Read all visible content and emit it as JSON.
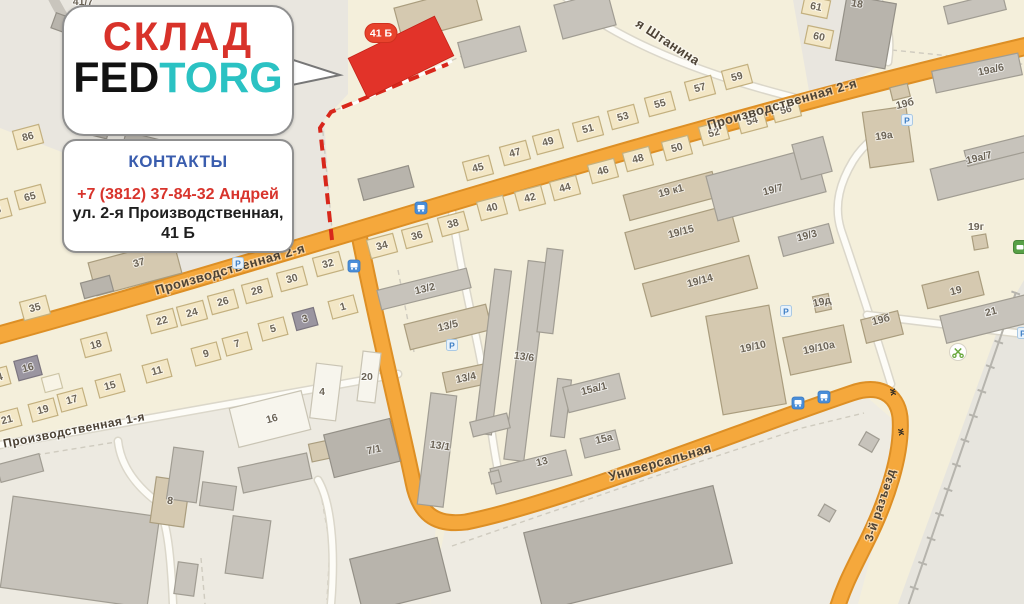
{
  "overlay": {
    "title": "СКЛАД",
    "brand_fed": "FED",
    "brand_torg": "TORG",
    "contacts_title": "КОНТАКТЫ",
    "phone": "+7 (3812) 37-84-32 Андрей",
    "address_line1": "ул. 2-я Производственная,",
    "address_line2": "41 Б",
    "badge": "41 Б",
    "colors": {
      "accent_red": "#d8322a",
      "brand_teal": "#2bc2c3",
      "contacts_blue": "#3a5dae"
    }
  },
  "map": {
    "palette": {
      "base": "#f4efdb",
      "zone_gray": "#e9e6df",
      "zone_ind": "#edeae1",
      "zone_br": "#e7e5de",
      "road_fill": "#f5a83c",
      "road_casing": "#dd8f25",
      "minor_fill": "#fdfcf7",
      "minor_casing": "#dbd7ca",
      "gray_road": "#c9c5bd",
      "rail": "#b6b4ad",
      "parcel": "#cfcbbf",
      "route_red": "#d8271b",
      "bld_red": "#e23329",
      "label": "#6c6457",
      "street_label": "#4d4336",
      "h": [
        "#f3e7c6",
        "#c3b07f"
      ],
      "hg": [
        "#9a95a0",
        "#7c7680"
      ],
      "hw": [
        "#f8f4e6",
        "#cdc5a6"
      ],
      "tan": [
        "#d5c9b0",
        "#aa9d7e"
      ],
      "gray": [
        "#c7c3bb",
        "#a19d93"
      ],
      "dark": [
        "#b8b4ac",
        "#949087"
      ],
      "white": [
        "#f7f5ed",
        "#c9c4b4"
      ]
    },
    "zones": [
      {
        "pts": "0,0 348,0 348,94 324,120 333,240 150,298 95,165 0,128",
        "fill": "#e9e6df"
      },
      {
        "pts": "793,0 880,0 893,42 885,62 812,108",
        "fill": "#e9e6df"
      },
      {
        "pts": "430,604 446,524 520,518 660,464 800,414 868,398 898,424 888,492 858,604",
        "fill": "#eeebe2"
      },
      {
        "pts": "1024,280 1024,604 898,604 1002,318",
        "fill": "#e7e5de"
      },
      {
        "pts": "0,448 398,375 414,480 436,524 430,604 0,604",
        "fill": "#edeae1"
      }
    ],
    "parcel_lines": [
      "M 322 122 L 333 240",
      "M 336 110 L 462 56",
      "M 892 50 L 1008 62 L 1034 66",
      "M 452 546 L 650 478 L 802 428 L 864 413",
      "M 36 455 L 116 442",
      "M 398 270 L 414 352",
      "M 201 558 L 205 604",
      "M 322 500 L 330 545 L 327 600"
    ],
    "minor_roads": [
      "M -6 446 L 398 374",
      "M 560 -8 C 600 30 680 70 808 101",
      "M 877 -4 C 886 20 892 34 888 62",
      "M 891 384 C 872 322 854 268 841 230 C 833 204 841 181 853 161 C 864 143 882 130 904 117",
      "M 867 315 L 1016 333 L 1034 336",
      "M 452 212 C 462 280 477 335 485 383 C 489 415 493 446 498 470",
      "M 118 441 C 121 468 138 487 156 501 C 168 520 171 560 173 604",
      "M 318 480 C 330 500 336 545 331 604"
    ],
    "gray_road": "M 52 -4 C 68 30 96 62 132 90",
    "roads": {
      "branch": "M 358 230 C 376 322 403 433 413 482 C 419 513 434 526 466 522 C 560 503 742 430 852 393 C 878 384 897 393 900 417 C 903 454 886 503 866 543 C 851 573 843 588 836 612",
      "main": "M -12 338 C 330 244 640 136 1036 44"
    },
    "railway": "M 1016 292 L 908 606",
    "route": {
      "dash": "M 332 240 L 320 128 L 331 112 L 448 64",
      "underlay": "M 341 109 L 452 61"
    },
    "red_building": {
      "cx": 401,
      "cy": 57,
      "w": 96,
      "h": 44,
      "r": -26
    },
    "badge": {
      "x": 381,
      "y": 33,
      "w": 32,
      "h": 19
    },
    "buildings": [
      [
        64,
        24,
        22,
        16,
        20,
        "dark"
      ],
      [
        93,
        119,
        36,
        32,
        14,
        "dark"
      ],
      [
        141,
        163,
        44,
        54,
        14,
        "dark"
      ],
      [
        386,
        183,
        52,
        22,
        -15,
        "dark"
      ],
      [
        135,
        268,
        88,
        34,
        -15,
        "tan"
      ],
      [
        97,
        287,
        30,
        16,
        -15,
        "dark"
      ],
      [
        438,
        14,
        82,
        34,
        -15,
        "tan"
      ],
      [
        492,
        47,
        64,
        26,
        -15,
        "gray"
      ],
      [
        585,
        15,
        55,
        35,
        -15,
        "gray"
      ],
      [
        28,
        137,
        27,
        19,
        -15,
        "h"
      ],
      [
        30,
        197,
        27,
        19,
        -15,
        "h"
      ],
      [
        -2,
        210,
        24,
        18,
        -15,
        "h"
      ],
      [
        35,
        308,
        27,
        19,
        -15,
        "h"
      ],
      [
        478,
        168,
        27,
        19,
        -15,
        "h"
      ],
      [
        515,
        153,
        27,
        19,
        -15,
        "h"
      ],
      [
        548,
        142,
        27,
        19,
        -15,
        "h"
      ],
      [
        588,
        129,
        27,
        19,
        -15,
        "h"
      ],
      [
        623,
        117,
        27,
        19,
        -15,
        "h"
      ],
      [
        660,
        104,
        27,
        19,
        -15,
        "h"
      ],
      [
        700,
        88,
        27,
        19,
        -15,
        "h"
      ],
      [
        737,
        77,
        27,
        19,
        -15,
        "h"
      ],
      [
        816,
        7,
        26,
        18,
        12,
        "h"
      ],
      [
        819,
        37,
        26,
        18,
        12,
        "h"
      ],
      [
        382,
        246,
        27,
        19,
        -15,
        "h"
      ],
      [
        417,
        236,
        27,
        19,
        -15,
        "h"
      ],
      [
        453,
        224,
        27,
        19,
        -15,
        "h"
      ],
      [
        492,
        208,
        27,
        19,
        -15,
        "h"
      ],
      [
        530,
        198,
        27,
        19,
        -15,
        "h"
      ],
      [
        565,
        188,
        27,
        19,
        -15,
        "h"
      ],
      [
        603,
        171,
        27,
        19,
        -15,
        "h"
      ],
      [
        638,
        159,
        27,
        19,
        -15,
        "h"
      ],
      [
        677,
        148,
        27,
        19,
        -15,
        "h"
      ],
      [
        714,
        133,
        27,
        19,
        -15,
        "h"
      ],
      [
        752,
        121,
        27,
        19,
        -15,
        "h"
      ],
      [
        786,
        110,
        27,
        19,
        -15,
        "h"
      ],
      [
        162,
        321,
        27,
        19,
        -15,
        "h"
      ],
      [
        192,
        313,
        27,
        19,
        -15,
        "h"
      ],
      [
        223,
        302,
        27,
        19,
        -15,
        "h"
      ],
      [
        257,
        291,
        27,
        19,
        -15,
        "h"
      ],
      [
        292,
        279,
        27,
        19,
        -15,
        "h"
      ],
      [
        328,
        264,
        27,
        19,
        -15,
        "h"
      ],
      [
        96,
        345,
        27,
        19,
        -15,
        "h"
      ],
      [
        28,
        368,
        24,
        20,
        -15,
        "hg"
      ],
      [
        -3,
        378,
        24,
        18,
        -15,
        "h"
      ],
      [
        7,
        420,
        26,
        18,
        -15,
        "h"
      ],
      [
        43,
        410,
        26,
        18,
        -15,
        "h"
      ],
      [
        72,
        400,
        26,
        18,
        -15,
        "h"
      ],
      [
        110,
        386,
        26,
        18,
        -15,
        "h"
      ],
      [
        157,
        371,
        26,
        18,
        -15,
        "h"
      ],
      [
        206,
        354,
        26,
        18,
        -15,
        "h"
      ],
      [
        237,
        344,
        26,
        18,
        -15,
        "h"
      ],
      [
        273,
        329,
        26,
        18,
        -15,
        "h"
      ],
      [
        305,
        319,
        22,
        18,
        -15,
        "hg"
      ],
      [
        343,
        307,
        26,
        18,
        -15,
        "h"
      ],
      [
        52,
        383,
        18,
        15,
        -15,
        "hw"
      ],
      [
        424,
        289,
        92,
        20,
        -14,
        "gray"
      ],
      [
        448,
        327,
        84,
        26,
        -14,
        "tan"
      ],
      [
        466,
        378,
        44,
        20,
        -12,
        "tan"
      ],
      [
        493,
        352,
        17,
        165,
        7,
        "gray"
      ],
      [
        526,
        361,
        20,
        200,
        7,
        "gray"
      ],
      [
        550,
        291,
        16,
        84,
        7,
        "gray"
      ],
      [
        561,
        408,
        14,
        58,
        7,
        "gray"
      ],
      [
        490,
        425,
        38,
        15,
        -14,
        "gray"
      ],
      [
        437,
        450,
        26,
        112,
        7,
        "gray"
      ],
      [
        531,
        472,
        78,
        26,
        -14,
        "gray"
      ],
      [
        594,
        393,
        58,
        26,
        -14,
        "gray"
      ],
      [
        600,
        444,
        36,
        20,
        -14,
        "gray"
      ],
      [
        495,
        477,
        10,
        12,
        -14,
        "gray"
      ],
      [
        671,
        196,
        92,
        26,
        -15,
        "tan"
      ],
      [
        682,
        237,
        108,
        38,
        -15,
        "tan"
      ],
      [
        766,
        184,
        112,
        46,
        -15,
        "gray"
      ],
      [
        812,
        158,
        32,
        36,
        -15,
        "gray"
      ],
      [
        806,
        240,
        52,
        20,
        -15,
        "gray"
      ],
      [
        700,
        286,
        110,
        34,
        -15,
        "tan"
      ],
      [
        746,
        360,
        64,
        100,
        -10,
        "tan"
      ],
      [
        817,
        350,
        62,
        38,
        -12,
        "tan"
      ],
      [
        822,
        303,
        16,
        16,
        -12,
        "tan"
      ],
      [
        882,
        327,
        38,
        24,
        -14,
        "tan"
      ],
      [
        953,
        290,
        58,
        24,
        -14,
        "tan"
      ],
      [
        986,
        319,
        88,
        28,
        -14,
        "gray"
      ],
      [
        888,
        137,
        44,
        56,
        -8,
        "tan"
      ],
      [
        977,
        73,
        88,
        22,
        -12,
        "gray"
      ],
      [
        985,
        172,
        105,
        32,
        -14,
        "gray"
      ],
      [
        1000,
        150,
        70,
        16,
        -14,
        "gray"
      ],
      [
        980,
        242,
        14,
        14,
        -10,
        "tan"
      ],
      [
        900,
        92,
        18,
        13,
        -14,
        "tan"
      ],
      [
        866,
        32,
        50,
        66,
        10,
        "dark"
      ],
      [
        975,
        8,
        60,
        18,
        -14,
        "gray"
      ],
      [
        20,
        468,
        44,
        18,
        -15,
        "gray"
      ],
      [
        80,
        552,
        148,
        92,
        8,
        "gray"
      ],
      [
        170,
        502,
        34,
        46,
        8,
        "tan"
      ],
      [
        185,
        475,
        30,
        52,
        8,
        "gray"
      ],
      [
        218,
        496,
        34,
        24,
        8,
        "gray"
      ],
      [
        275,
        473,
        70,
        26,
        -12,
        "gray"
      ],
      [
        248,
        547,
        38,
        58,
        8,
        "gray"
      ],
      [
        186,
        579,
        20,
        32,
        8,
        "gray"
      ],
      [
        325,
        450,
        30,
        18,
        -12,
        "tan"
      ],
      [
        400,
        575,
        90,
        55,
        -14,
        "dark"
      ],
      [
        362,
        448,
        68,
        44,
        -14,
        "dark"
      ],
      [
        270,
        419,
        74,
        40,
        -14,
        "white"
      ],
      [
        326,
        392,
        26,
        55,
        7,
        "white"
      ],
      [
        369,
        377,
        18,
        50,
        7,
        "white"
      ],
      [
        628,
        548,
        195,
        80,
        -14,
        "dark"
      ],
      [
        869,
        442,
        15,
        15,
        30,
        "gray"
      ],
      [
        827,
        513,
        13,
        13,
        30,
        "gray"
      ]
    ],
    "building_labels": [
      [
        "45",
        478,
        168
      ],
      [
        "47",
        515,
        153
      ],
      [
        "49",
        548,
        142
      ],
      [
        "51",
        588,
        129
      ],
      [
        "53",
        623,
        117
      ],
      [
        "55",
        660,
        104
      ],
      [
        "57",
        700,
        88
      ],
      [
        "59",
        737,
        77
      ],
      [
        "61",
        816,
        7,
        12
      ],
      [
        "60",
        819,
        37,
        12
      ],
      [
        "34",
        382,
        246
      ],
      [
        "36",
        417,
        236
      ],
      [
        "38",
        453,
        224
      ],
      [
        "40",
        492,
        208
      ],
      [
        "42",
        530,
        198
      ],
      [
        "44",
        565,
        188
      ],
      [
        "46",
        603,
        171
      ],
      [
        "48",
        638,
        159
      ],
      [
        "50",
        677,
        148
      ],
      [
        "52",
        714,
        133
      ],
      [
        "54",
        752,
        121
      ],
      [
        "56",
        786,
        110
      ],
      [
        "22",
        162,
        321
      ],
      [
        "24",
        192,
        313
      ],
      [
        "26",
        223,
        302
      ],
      [
        "28",
        257,
        291
      ],
      [
        "30",
        292,
        279
      ],
      [
        "32",
        328,
        264
      ],
      [
        "18",
        96,
        345
      ],
      [
        "16",
        28,
        368
      ],
      [
        "14",
        -3,
        378
      ],
      [
        "21",
        7,
        420
      ],
      [
        "19",
        43,
        410
      ],
      [
        "17",
        72,
        400
      ],
      [
        "15",
        110,
        386
      ],
      [
        "11",
        157,
        371
      ],
      [
        "9",
        206,
        354
      ],
      [
        "7",
        237,
        344
      ],
      [
        "5",
        273,
        329
      ],
      [
        "3",
        305,
        319
      ],
      [
        "1",
        343,
        307
      ],
      [
        "86",
        28,
        137
      ],
      [
        "65",
        30,
        197
      ],
      [
        "3",
        -2,
        210
      ],
      [
        "35",
        35,
        308
      ],
      [
        "37",
        139,
        263
      ],
      [
        "8",
        170,
        501,
        8
      ],
      [
        "16",
        272,
        419
      ],
      [
        "4",
        322,
        392,
        0
      ],
      [
        "20",
        367,
        377,
        0
      ],
      [
        "7/1",
        374,
        450,
        -12
      ],
      [
        "13/2",
        425,
        289,
        -14
      ],
      [
        "13/5",
        448,
        326,
        -14
      ],
      [
        "13/4",
        466,
        378,
        -12
      ],
      [
        "13/6",
        524,
        357,
        8
      ],
      [
        "13/1",
        440,
        446,
        8
      ],
      [
        "13",
        542,
        462,
        -14
      ],
      [
        "15а/1",
        594,
        389,
        -14
      ],
      [
        "15а",
        604,
        439,
        -14
      ],
      [
        "19 к1",
        671,
        191
      ],
      [
        "19/15",
        681,
        232
      ],
      [
        "19/7",
        773,
        190
      ],
      [
        "19/3",
        807,
        236
      ],
      [
        "19/14",
        700,
        281
      ],
      [
        "19/10",
        753,
        347,
        -12
      ],
      [
        "19/10а",
        819,
        348,
        -12
      ],
      [
        "19д",
        822,
        302,
        -12
      ],
      [
        "19б",
        881,
        320,
        -14
      ],
      [
        "19",
        956,
        291,
        -14
      ],
      [
        "21",
        991,
        312,
        -14
      ],
      [
        "19а",
        884,
        136,
        -8
      ],
      [
        "19б",
        905,
        104,
        -14
      ],
      [
        "19а/6",
        991,
        70,
        -12
      ],
      [
        "19а/7",
        979,
        158,
        -14
      ],
      [
        "19г",
        976,
        227,
        0
      ],
      [
        "18",
        857,
        4,
        10
      ],
      [
        "41/7",
        83,
        2,
        0
      ]
    ],
    "street_labels": [
      {
        "name": "Производственная 2-я",
        "x": 230,
        "y": 269,
        "r": -16,
        "s": 13
      },
      {
        "name": "Производственная 2-я",
        "x": 782,
        "y": 104,
        "r": -16,
        "s": 13
      },
      {
        "name": "я Штанина",
        "x": 668,
        "y": 42,
        "r": 33,
        "s": 13
      },
      {
        "name": "Производственная 1-я",
        "x": 74,
        "y": 430,
        "r": -11,
        "s": 12
      },
      {
        "name": "Универсальная",
        "x": 660,
        "y": 462,
        "r": -16,
        "s": 13
      },
      {
        "name": "3-й разъезд",
        "x": 880,
        "y": 505,
        "r": -72,
        "s": 12
      }
    ],
    "icons": [
      [
        "bus",
        421,
        208
      ],
      [
        "bus",
        354,
        266
      ],
      [
        "bus",
        798,
        403
      ],
      [
        "bus",
        824,
        397
      ],
      [
        "park",
        907,
        120
      ],
      [
        "park",
        452,
        345
      ],
      [
        "park",
        238,
        263
      ],
      [
        "park",
        786,
        311
      ],
      [
        "park",
        1023,
        333
      ],
      [
        "scis",
        958,
        352
      ],
      [
        "shop",
        1020,
        247
      ],
      [
        "rail",
        893,
        392
      ],
      [
        "rail",
        901,
        432
      ]
    ],
    "icon_glyphs": {
      "park": "P",
      "rail": "ж"
    }
  }
}
